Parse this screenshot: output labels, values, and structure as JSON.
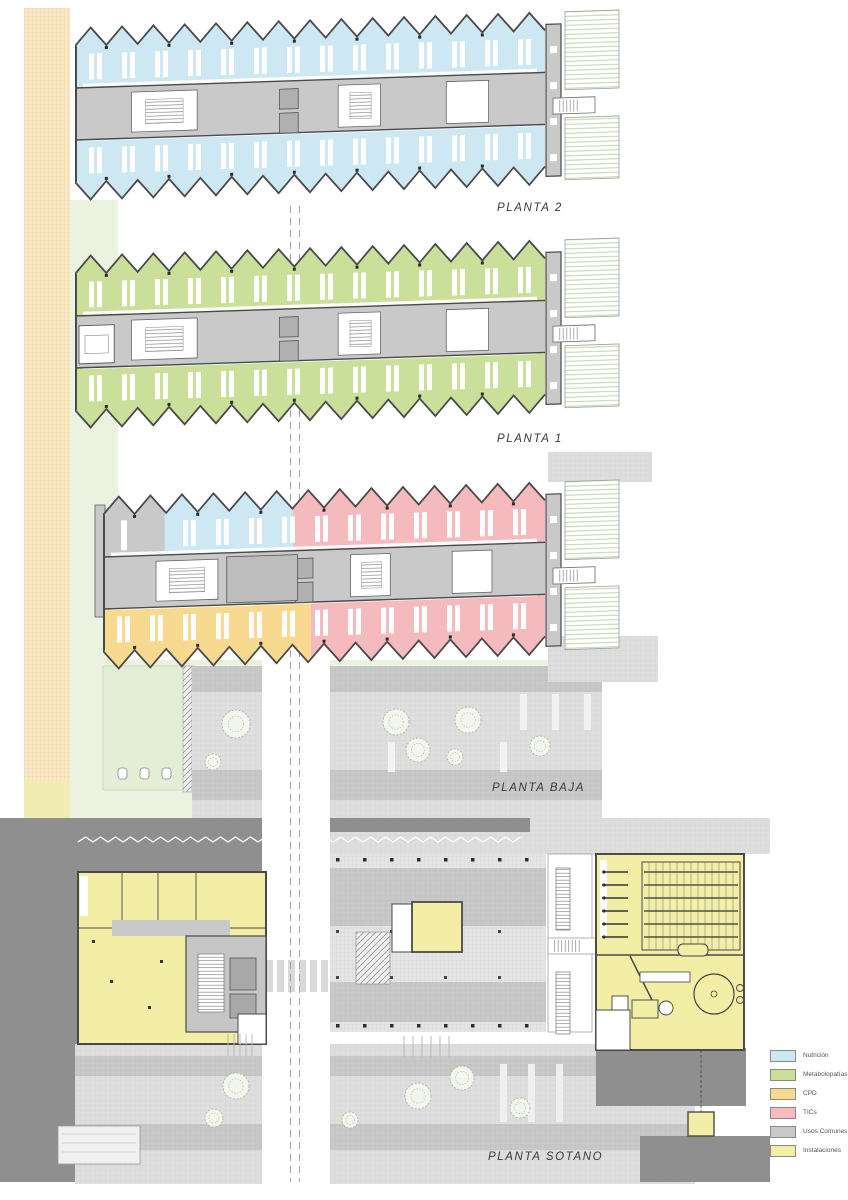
{
  "floors": [
    {
      "id": "planta-2",
      "label": "PLANTA 2",
      "zones": {
        "top": [
          {
            "use": "nutricion",
            "frac": 1
          }
        ],
        "bottom": [
          {
            "use": "nutricion",
            "frac": 1
          }
        ]
      }
    },
    {
      "id": "planta-1",
      "label": "PLANTA 1",
      "zones": {
        "top": [
          {
            "use": "metabolopatias",
            "frac": 1
          }
        ],
        "bottom": [
          {
            "use": "metabolopatias",
            "frac": 1
          }
        ]
      }
    },
    {
      "id": "planta-baja",
      "label": "PLANTA BAJA",
      "zones": {
        "top": [
          {
            "use": "usos_comunes",
            "frac": 0.14
          },
          {
            "use": "nutricion",
            "frac": 0.29
          },
          {
            "use": "tics",
            "frac": 0.57
          }
        ],
        "bottom": [
          {
            "use": "cpd",
            "frac": 0.47
          },
          {
            "use": "tics",
            "frac": 0.53
          }
        ]
      }
    },
    {
      "id": "planta-sotano",
      "label": "PLANTA SOTANO",
      "zones": {
        "left_block": "instalaciones",
        "center_room": "instalaciones",
        "right_block": "instalaciones",
        "core": "usos_comunes",
        "parking": "usos_comunes"
      }
    }
  ],
  "legend": {
    "items": [
      {
        "use": "nutricion",
        "label": "Nutrición"
      },
      {
        "use": "metabolopatias",
        "label": "Metabolopatías"
      },
      {
        "use": "cpd",
        "label": "CPD"
      },
      {
        "use": "tics",
        "label": "TICs"
      },
      {
        "use": "usos_comunes",
        "label": "Usos Comunes"
      },
      {
        "use": "instalaciones",
        "label": "Instalaciones"
      }
    ]
  },
  "colors": {
    "nutricion": "#cde8f3",
    "metabolopatias": "#cadf9a",
    "cpd": "#f7da90",
    "tics": "#f4babe",
    "usos_comunes": "#c9c9c9",
    "instalaciones": "#f2eea6",
    "wall": "#4a4a4a",
    "site_orange": "#f9e6c2",
    "site_orange_line": "#ecd3a4",
    "site_green": "#ebf3e0",
    "garden_green": "#e4eed6",
    "plaza_light": "#dedede",
    "plaza_dark": "#c8c8c8",
    "parking_light": "#e4e4e4",
    "basement_bg": "#8f8f8f",
    "annex_stripe": "#b9cfa4",
    "road_dash": "#9a9a9a"
  }
}
